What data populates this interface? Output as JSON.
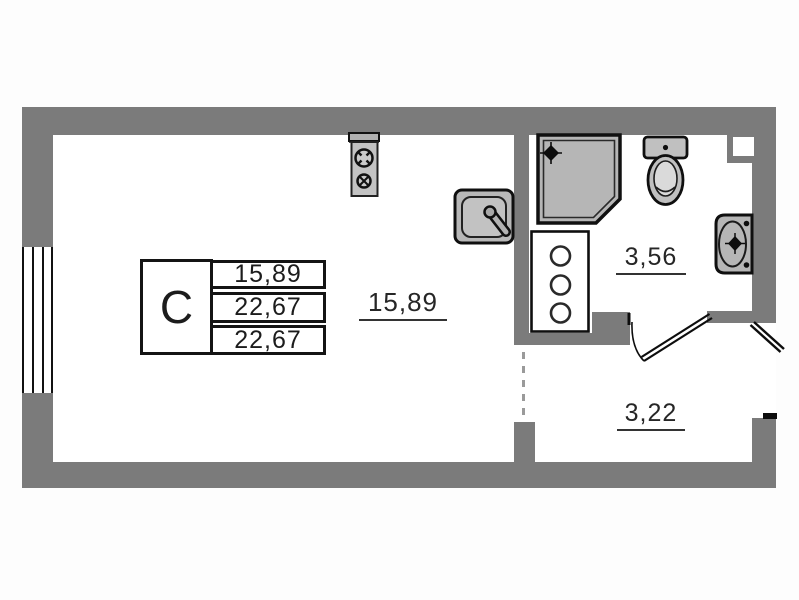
{
  "unit_table": {
    "letter": "С",
    "values": [
      "15,89",
      "22,67",
      "22,67"
    ]
  },
  "rooms": [
    {
      "id": "living-room",
      "area": "15,89"
    },
    {
      "id": "bathroom",
      "area": "3,56"
    },
    {
      "id": "hallway",
      "area": "3,22"
    }
  ],
  "fixtures": [
    "stove",
    "kitchen-sink",
    "shower",
    "toilet",
    "washbasin",
    "cabinet"
  ],
  "colors": {
    "wall": "#7b7b7b",
    "fixture_fill": "#bdbdbd",
    "outline": "#141414",
    "background": "#ffffff"
  }
}
